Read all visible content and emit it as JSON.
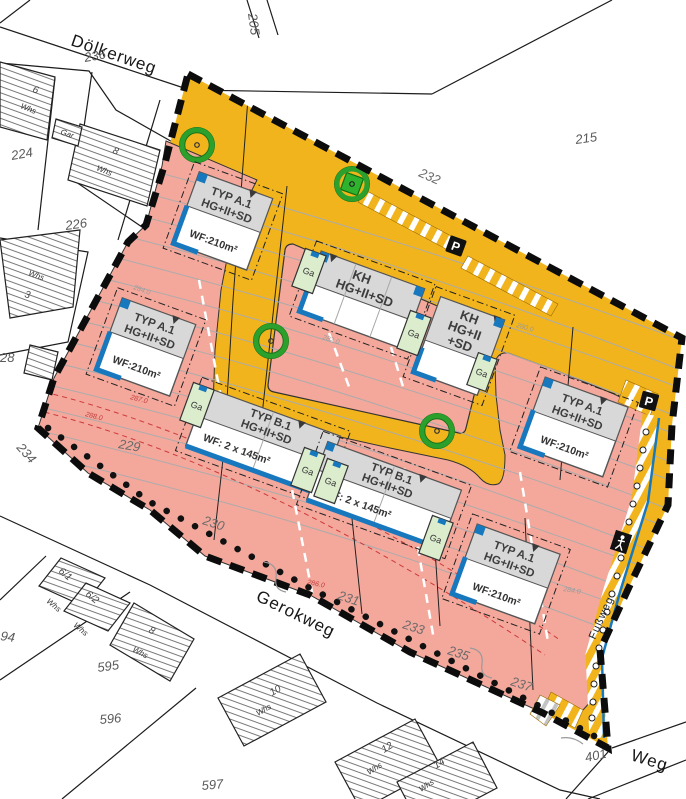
{
  "map": {
    "streets": {
      "dolkerweg": "Dölkerweg",
      "gerokweg": "Gerokweg",
      "weg": "Weg",
      "fussweg": "Fußweg"
    },
    "plan_parcels": {
      "p229": "229",
      "p230": "230",
      "p231": "231",
      "p232": "232",
      "p233": "233",
      "p235": "235",
      "p237": "237"
    },
    "outside_parcels": {
      "p236": "236",
      "p205": "205",
      "p215": "215",
      "p224": "224",
      "p226": "226",
      "p228": "28",
      "p234": "234",
      "p594": "94",
      "p595": "595",
      "p596": "596",
      "p597": "597",
      "p401": "401"
    },
    "houses": {
      "h6": "6",
      "h8a": "8",
      "h3": "3",
      "h61": "6/1",
      "h62": "6/2",
      "h8b": "8",
      "h10": "10",
      "h12": "12",
      "h14": "14",
      "whs": "Whs",
      "gar": "Gar"
    },
    "buildings": [
      {
        "id": "typ-a1-nw",
        "lines": [
          "TYP A.1",
          "HG+II+SD"
        ],
        "wf": "WF:210m²"
      },
      {
        "id": "typ-a1-w",
        "lines": [
          "TYP A.1",
          "HG+II+SD"
        ],
        "wf": "WF:210m²"
      },
      {
        "id": "kh-west",
        "lines": [
          "KH",
          "HG+II+SD"
        ],
        "wf": ""
      },
      {
        "id": "kh-east",
        "lines": [
          "KH",
          "HG+II",
          "+SD"
        ],
        "wf": ""
      },
      {
        "id": "typ-b1-w",
        "lines": [
          "TYP B.1",
          "HG+II+SD"
        ],
        "wf": "WF: 2 x 145m²"
      },
      {
        "id": "typ-b1-e",
        "lines": [
          "TYP B.1",
          "HG+II+SD"
        ],
        "wf": "WF: 2 x 145m²"
      },
      {
        "id": "typ-a1-e",
        "lines": [
          "TYP A.1",
          "HG+II+SD"
        ],
        "wf": "WF:210m²"
      },
      {
        "id": "typ-a1-s",
        "lines": [
          "TYP A.1",
          "HG+II+SD"
        ],
        "wf": "WF:210m²"
      }
    ],
    "garage_label": "Ga",
    "parking_label": "P",
    "contour_labels": {
      "c280": "280.0",
      "c282": "282.0",
      "c284a": "284.0",
      "c284b": "284.0",
      "c286": "286.0",
      "c287": "287.0",
      "c288": "288.0"
    },
    "colors": {
      "road_orange": "#F2B41C",
      "residential_pink": "#F4A89C",
      "garage_green": "#DCEDCE",
      "accent_blue": "#1878BE",
      "tree_green": "#2CA02C",
      "boundary_black": "#111111"
    }
  }
}
